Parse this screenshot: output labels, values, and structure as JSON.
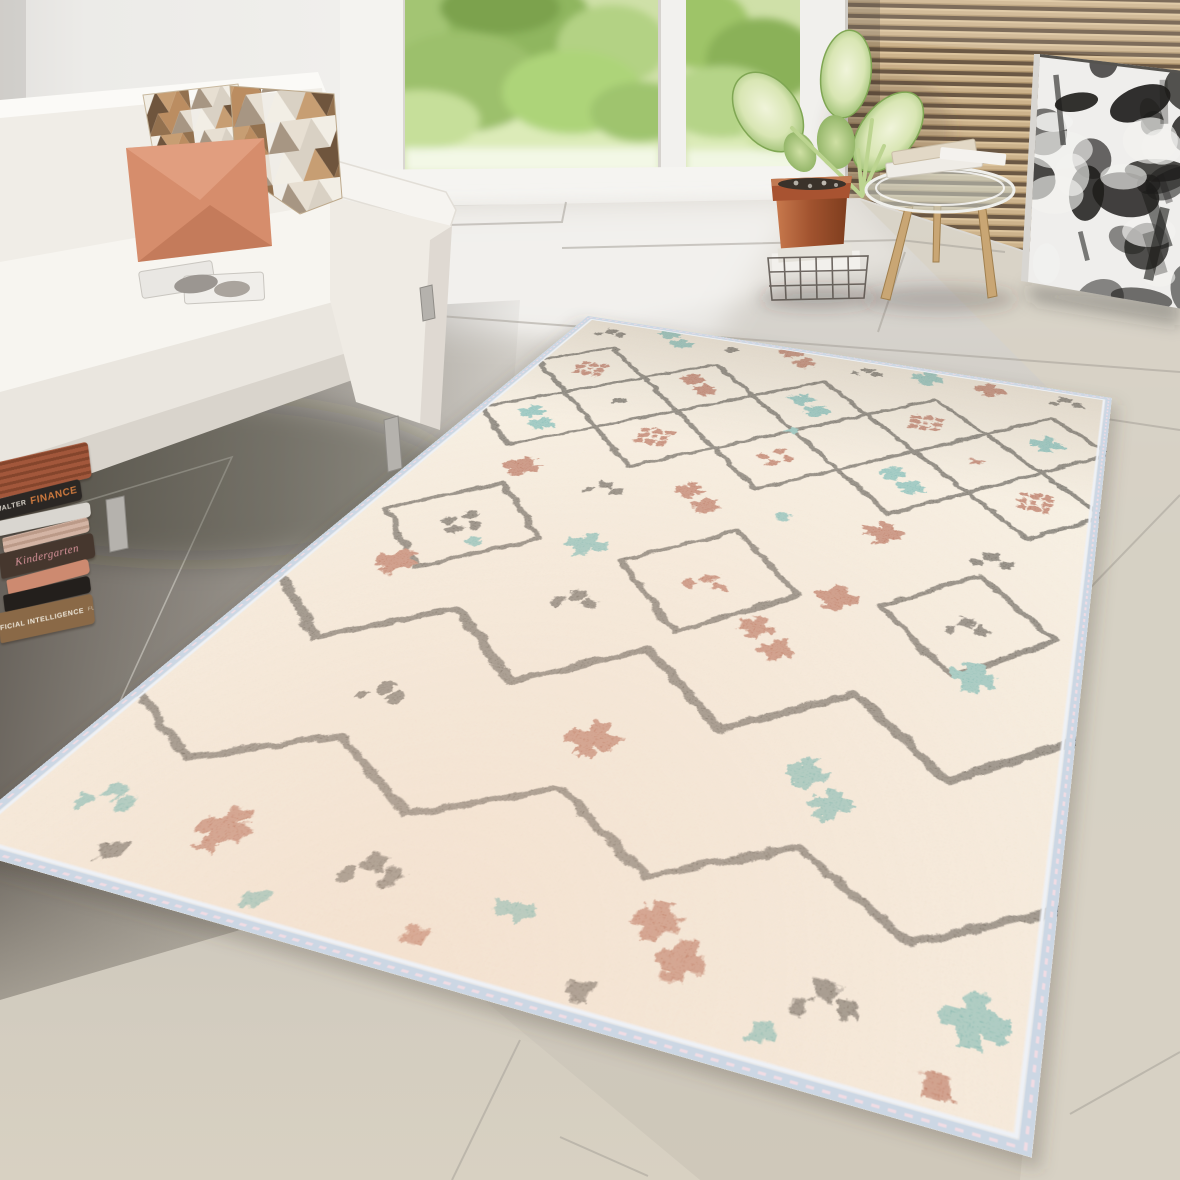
{
  "scene": {
    "label": "Bright living room with white sofa, glass doors to a garden, wood slat wall, abstract art and a cream Berber-style area rug",
    "width": 1180,
    "height": 1180
  },
  "palette": {
    "wall": "#eae8e5",
    "window_frame": "#f4f3f0",
    "foliage_greens": [
      "#a3c573",
      "#8fb65f",
      "#b3d284",
      "#9cc06c",
      "#add479",
      "#c6df9a",
      "#d6e8ac",
      "#7ba24d"
    ],
    "slat_wood": "#cdb38c",
    "slat_gap": "#6b5844",
    "floor_light": "#dcd9d3",
    "floor_mid": "#c9c5be",
    "floor_dark": "#6e6962",
    "floor_beige": "#d8d2c5",
    "grout_light": "#a7a29a",
    "grout_dark": "#e4e1da",
    "sofa_white": "#f5f3ef",
    "sofa_shadow": "#ddd8d1",
    "pillow_salmon": "#d68d6c",
    "pillow_salmon_deep": "#bf6a45",
    "pillow_triangles": [
      "#f2eee5",
      "#c79e73",
      "#93714f",
      "#a79683",
      "#d9d1c4",
      "#6f553d",
      "#bb8d61",
      "#e7dfd2"
    ],
    "terracotta": "#b05a38",
    "leaf_edge": "#8ab35e",
    "leaf_center": "#eef3da",
    "wood_leg": "#c9a674",
    "art_canvas": "#efeeec",
    "art_ink": "#1d1c1a"
  },
  "books": [
    {
      "name": "striped-red-book",
      "color": "#a2573b",
      "stripe": "#84452c",
      "parts": []
    },
    {
      "name": "finance-book",
      "color": "#2b2724",
      "parts": [
        {
          "text": "WALTER",
          "color": "#ddd8ce",
          "size": 7,
          "bold": true
        },
        {
          "text": "FINANCE",
          "color": "#cf7a3e",
          "size": 10,
          "bold": true
        }
      ]
    },
    {
      "name": "white-book",
      "color": "#d9d6d0",
      "parts": []
    },
    {
      "name": "pink-striped-book",
      "color": "#d3b4a4",
      "stripe": "#bb9a88",
      "parts": []
    },
    {
      "name": "kindergarten-book",
      "color": "#46372e",
      "parts": [
        {
          "text": "Kindergarten",
          "color": "#d9949b",
          "size": 11,
          "italic": true,
          "serif": true
        }
      ]
    },
    {
      "name": "salmon-book",
      "color": "#cd8a70",
      "parts": []
    },
    {
      "name": "black-book",
      "color": "#231f1c",
      "parts": []
    },
    {
      "name": "ai-book",
      "color": "#8a6947",
      "parts": [
        {
          "text": "ARTIFICIAL INTELLIGENCE",
          "color": "#efe9dc",
          "size": 7,
          "bold": true
        },
        {
          "text": "FUTURE",
          "color": "#d9d0bd",
          "size": 5
        }
      ]
    }
  ],
  "rug": {
    "quad": [
      [
        588,
        316
      ],
      [
        1112,
        398
      ],
      [
        1032,
        1158
      ],
      [
        -55,
        845
      ]
    ],
    "flat_w": 760,
    "flat_h": 1060,
    "base": "#f2e8d7",
    "base_far": "#e6dbc9",
    "near_tint": "#eec9ae",
    "binding": "#ccd7e4",
    "binding_light": "#eef1f6",
    "stitch": "#f0dce4",
    "line": "#332e28",
    "rust": "#9c3e22",
    "teal": "#4ba39f",
    "black": "#332e28",
    "lattice": {
      "x0": 4,
      "cell": 152,
      "cols": 5,
      "row_ys": [
        168,
        320
      ],
      "half": 76,
      "stroke_w": 7
    },
    "diamonds": [
      {
        "cx": 118,
        "cy": 566,
        "r": 88
      },
      {
        "cx": 392,
        "cy": 576,
        "r": 92
      },
      {
        "cx": 648,
        "cy": 566,
        "r": 84
      }
    ],
    "zigzags": [
      {
        "w": 9,
        "points": [
          [
            0,
            700
          ],
          [
            95,
            778
          ],
          [
            190,
            700
          ],
          [
            285,
            778
          ],
          [
            380,
            700
          ],
          [
            475,
            778
          ],
          [
            570,
            700
          ],
          [
            665,
            778
          ],
          [
            760,
            700
          ]
        ]
      },
      {
        "w": 7,
        "points": [
          [
            0,
            882
          ],
          [
            95,
            938
          ],
          [
            190,
            880
          ],
          [
            285,
            938
          ],
          [
            380,
            880
          ],
          [
            475,
            938
          ],
          [
            570,
            880
          ],
          [
            665,
            938
          ],
          [
            760,
            880
          ]
        ]
      }
    ],
    "motifs": [
      {
        "t": "dots",
        "c": "black",
        "x": 55,
        "y": 40
      },
      {
        "t": "cross2",
        "c": "teal",
        "x": 150,
        "y": 32
      },
      {
        "t": "dot",
        "c": "black",
        "x": 235,
        "y": 38
      },
      {
        "t": "cross2",
        "c": "rust",
        "x": 330,
        "y": 30
      },
      {
        "t": "dots",
        "c": "black",
        "x": 430,
        "y": 36
      },
      {
        "t": "cross",
        "c": "teal",
        "x": 515,
        "y": 30
      },
      {
        "t": "cross",
        "c": "rust",
        "x": 600,
        "y": 36
      },
      {
        "t": "dots",
        "c": "black",
        "x": 700,
        "y": 32
      },
      {
        "t": "hash",
        "c": "rust",
        "x": 80,
        "y": 168
      },
      {
        "t": "cross2",
        "c": "rust",
        "x": 232,
        "y": 162
      },
      {
        "t": "cross2",
        "c": "teal",
        "x": 384,
        "y": 168
      },
      {
        "t": "hash",
        "c": "rust",
        "x": 536,
        "y": 164
      },
      {
        "t": "cross",
        "c": "teal",
        "x": 688,
        "y": 168
      },
      {
        "t": "dot",
        "c": "black",
        "x": 156,
        "y": 244
      },
      {
        "t": "dot",
        "c": "teal",
        "x": 384,
        "y": 244
      },
      {
        "t": "dot",
        "c": "rust",
        "x": 612,
        "y": 244
      },
      {
        "t": "cross2",
        "c": "teal",
        "x": 80,
        "y": 322
      },
      {
        "t": "hash",
        "c": "rust",
        "x": 232,
        "y": 318
      },
      {
        "t": "quadDots",
        "c": "rust",
        "x": 384,
        "y": 316
      },
      {
        "t": "cross2",
        "c": "teal",
        "x": 536,
        "y": 318
      },
      {
        "t": "hash",
        "c": "rust",
        "x": 688,
        "y": 316
      },
      {
        "t": "cross",
        "c": "rust",
        "x": 120,
        "y": 438
      },
      {
        "t": "dots",
        "c": "black",
        "x": 225,
        "y": 444
      },
      {
        "t": "cross2",
        "c": "rust",
        "x": 330,
        "y": 436
      },
      {
        "t": "dot",
        "c": "teal",
        "x": 430,
        "y": 442
      },
      {
        "t": "cross",
        "c": "rust",
        "x": 540,
        "y": 436
      },
      {
        "t": "dots",
        "c": "black",
        "x": 655,
        "y": 444
      },
      {
        "t": "quadDots",
        "c": "black",
        "x": 118,
        "y": 566
      },
      {
        "t": "dot",
        "c": "teal",
        "x": 146,
        "y": 592
      },
      {
        "t": "dots",
        "c": "rust",
        "x": 392,
        "y": 576
      },
      {
        "t": "dots",
        "c": "black",
        "x": 648,
        "y": 566
      },
      {
        "t": "cross",
        "c": "teal",
        "x": 255,
        "y": 560
      },
      {
        "t": "cross",
        "c": "rust",
        "x": 520,
        "y": 566
      },
      {
        "t": "cross",
        "c": "rust",
        "x": 95,
        "y": 650
      },
      {
        "t": "dots",
        "c": "black",
        "x": 285,
        "y": 644
      },
      {
        "t": "cross2",
        "c": "rust",
        "x": 475,
        "y": 650
      },
      {
        "t": "cross",
        "c": "teal",
        "x": 665,
        "y": 645
      },
      {
        "t": "dots",
        "c": "black",
        "x": 190,
        "y": 818
      },
      {
        "t": "cross",
        "c": "rust",
        "x": 380,
        "y": 822
      },
      {
        "t": "cross2",
        "c": "teal",
        "x": 570,
        "y": 818
      },
      {
        "t": "dots",
        "c": "teal",
        "x": 70,
        "y": 982
      },
      {
        "t": "cross",
        "c": "rust",
        "x": 170,
        "y": 990
      },
      {
        "t": "dots",
        "c": "black",
        "x": 290,
        "y": 984
      },
      {
        "t": "dash",
        "c": "teal",
        "x": 400,
        "y": 992
      },
      {
        "t": "cross2",
        "c": "rust",
        "x": 510,
        "y": 984
      },
      {
        "t": "dots",
        "c": "black",
        "x": 620,
        "y": 990
      },
      {
        "t": "cross",
        "c": "teal",
        "x": 716,
        "y": 984
      },
      {
        "t": "dot",
        "c": "black",
        "x": 110,
        "y": 1030
      },
      {
        "t": "dot",
        "c": "teal",
        "x": 230,
        "y": 1036
      },
      {
        "t": "dot",
        "c": "rust",
        "x": 350,
        "y": 1030
      },
      {
        "t": "dot",
        "c": "black",
        "x": 470,
        "y": 1036
      },
      {
        "t": "dot",
        "c": "teal",
        "x": 590,
        "y": 1030
      },
      {
        "t": "dot",
        "c": "rust",
        "x": 700,
        "y": 1034
      }
    ]
  }
}
